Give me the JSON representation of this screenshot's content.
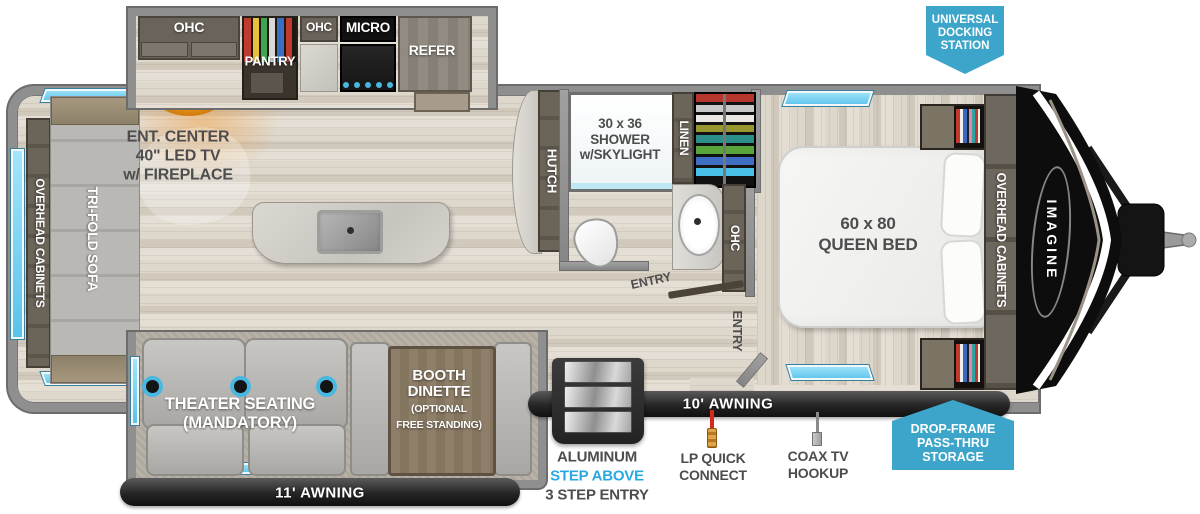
{
  "kitchen": {
    "ohc_left": "OHC",
    "pantry": "PANTRY",
    "ohc_mid": "OHC",
    "micro": "MICRO",
    "refer": "REFER"
  },
  "living": {
    "ent1": "ENT. CENTER",
    "ent2": "40\" LED TV",
    "ent3": "w/ FIREPLACE",
    "overhead": "OVERHEAD CABINETS",
    "sofa": "TRI-FOLD SOFA",
    "hutch": "HUTCH"
  },
  "bath": {
    "shower1": "30 x 36",
    "shower2": "SHOWER",
    "shower3": "w/SKYLIGHT",
    "linen": "LINEN",
    "ohc": "OHC",
    "entry": "ENTRY"
  },
  "bed": {
    "size1": "60 x 80",
    "size2": "QUEEN BED",
    "overhead": "OVERHEAD CABINETS",
    "entry": "ENTRY"
  },
  "front": {
    "brand": "IMAGINE"
  },
  "slideout": {
    "theater1": "THEATER SEATING",
    "theater2": "(MANDATORY)",
    "dinette1": "BOOTH",
    "dinette2": "DINETTE",
    "dinette3": "(OPTIONAL",
    "dinette4": "FREE STANDING)"
  },
  "exterior": {
    "awning11": "11' AWNING",
    "awning10": "10' AWNING",
    "step1": "ALUMINUM",
    "step2": "STEP ABOVE",
    "step3": "3 STEP ENTRY",
    "lp1": "LP QUICK",
    "lp2": "CONNECT",
    "coax1": "COAX TV",
    "coax2": "HOOKUP"
  },
  "badges": {
    "dock1": "UNIVERSAL",
    "dock2": "DOCKING",
    "dock3": "STATION",
    "store1": "DROP-FRAME",
    "store2": "PASS-THRU",
    "store3": "STORAGE"
  },
  "colors": {
    "badge_accent": "#3da5c9",
    "step_above_text": "#29a9e0",
    "window": "#7fd4f2",
    "label": "#4d4d4d"
  }
}
